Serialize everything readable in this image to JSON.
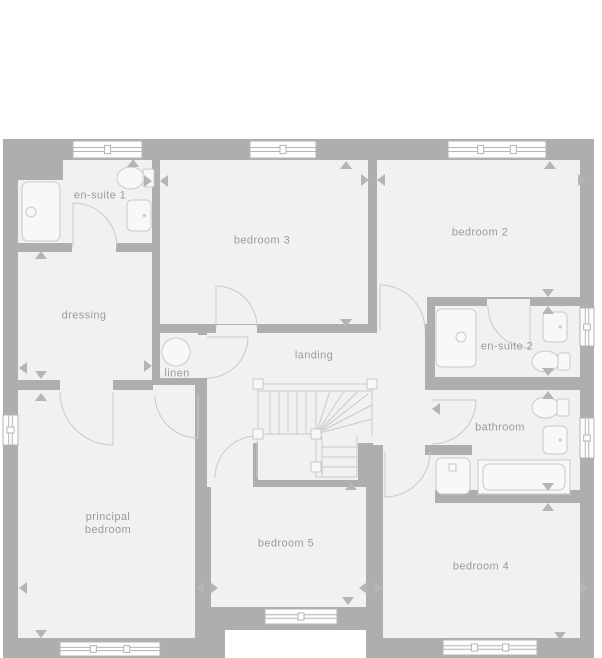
{
  "title": "first floor plan",
  "colors": {
    "wall": "#aeaeae",
    "floor": "#f1f1f1",
    "page": "#ffffff",
    "line": "#c9c9c9",
    "fixture_fill": "#f8f8f8",
    "window_fill": "#fdfdfd",
    "window_stroke": "#b5b5b5",
    "marker": "#b5b5b5",
    "label": "#9b9b9b"
  },
  "rooms": [
    {
      "id": "en-suite-1",
      "label": "en-suite 1",
      "x": 100,
      "y": 196
    },
    {
      "id": "bedroom-3",
      "label": "bedroom 3",
      "x": 262,
      "y": 241
    },
    {
      "id": "bedroom-2",
      "label": "bedroom 2",
      "x": 480,
      "y": 233
    },
    {
      "id": "dressing",
      "label": "dressing",
      "x": 84,
      "y": 316
    },
    {
      "id": "linen",
      "label": "linen",
      "x": 177,
      "y": 374
    },
    {
      "id": "landing",
      "label": "landing",
      "x": 314,
      "y": 356
    },
    {
      "id": "en-suite-2",
      "label": "en-suite 2",
      "x": 507,
      "y": 347
    },
    {
      "id": "bathroom",
      "label": "bathroom",
      "x": 500,
      "y": 428
    },
    {
      "id": "principal-bedroom",
      "label": "principal\nbedroom",
      "x": 108,
      "y": 524
    },
    {
      "id": "bedroom-5",
      "label": "bedroom 5",
      "x": 286,
      "y": 544
    },
    {
      "id": "bedroom-4",
      "label": "bedroom 4",
      "x": 481,
      "y": 567
    }
  ],
  "floorplan": {
    "footprint": [
      3,
      139,
      591,
      519
    ],
    "cutouts": [
      [
        225,
        630,
        141,
        28
      ]
    ],
    "floors": [
      [
        63,
        160,
        89,
        83
      ],
      [
        18,
        180,
        45,
        63
      ],
      [
        18,
        252,
        134,
        128
      ],
      [
        160,
        333,
        38,
        45
      ],
      [
        160,
        160,
        208,
        164
      ],
      [
        377,
        160,
        203,
        137
      ],
      [
        377,
        160,
        50,
        164
      ],
      [
        435,
        306,
        145,
        71
      ],
      [
        435,
        390,
        145,
        55
      ],
      [
        472,
        445,
        108,
        45
      ],
      [
        435,
        455,
        37,
        35
      ],
      [
        18,
        390,
        177,
        248
      ],
      [
        211,
        487,
        155,
        120
      ],
      [
        211,
        443,
        42,
        44
      ],
      [
        383,
        455,
        52,
        183
      ],
      [
        435,
        503,
        145,
        135
      ],
      [
        207,
        333,
        166,
        110
      ],
      [
        207,
        443,
        41,
        44
      ],
      [
        258,
        443,
        100,
        37
      ],
      [
        368,
        333,
        57,
        57
      ],
      [
        373,
        390,
        62,
        55
      ],
      [
        72,
        243,
        44,
        9
      ],
      [
        60,
        380,
        53,
        12
      ],
      [
        153,
        385,
        42,
        12
      ],
      [
        198,
        335,
        9,
        43
      ],
      [
        216,
        325,
        41,
        8
      ],
      [
        377,
        324,
        48,
        9
      ],
      [
        487,
        299,
        43,
        9
      ],
      [
        383,
        443,
        42,
        14
      ],
      [
        211,
        475,
        42,
        12
      ]
    ],
    "windows": [
      {
        "x": 73,
        "y": 141,
        "w": 69,
        "h": 17,
        "orient": "h",
        "mullions": 1
      },
      {
        "x": 250,
        "y": 141,
        "w": 66,
        "h": 17,
        "orient": "h",
        "mullions": 1
      },
      {
        "x": 448,
        "y": 141,
        "w": 98,
        "h": 17,
        "orient": "h",
        "mullions": 2
      },
      {
        "x": 3,
        "y": 415,
        "w": 15,
        "h": 30,
        "orient": "v",
        "mullions": 1
      },
      {
        "x": 580,
        "y": 308,
        "w": 14,
        "h": 38,
        "orient": "v",
        "mullions": 1
      },
      {
        "x": 580,
        "y": 418,
        "w": 14,
        "h": 40,
        "orient": "v",
        "mullions": 1
      },
      {
        "x": 60,
        "y": 642,
        "w": 100,
        "h": 14,
        "orient": "h",
        "mullions": 2
      },
      {
        "x": 265,
        "y": 609,
        "w": 72,
        "h": 15,
        "orient": "h",
        "mullions": 1
      },
      {
        "x": 443,
        "y": 640,
        "w": 94,
        "h": 15,
        "orient": "h",
        "mullions": 2
      }
    ],
    "doors": [
      {
        "r": 44,
        "start": [
          117,
          247
        ],
        "end": [
          73,
          203
        ],
        "sweep": 0,
        "leaf": [
          73,
          247,
          73,
          203
        ]
      },
      {
        "r": 53,
        "start": [
          60,
          392
        ],
        "end": [
          113,
          445
        ],
        "sweep": 0,
        "leaf": [
          113,
          392,
          113,
          445
        ]
      },
      {
        "r": 43,
        "start": [
          155,
          395
        ],
        "end": [
          198,
          438
        ],
        "sweep": 0,
        "leaf": [
          198,
          395,
          198,
          438
        ]
      },
      {
        "r": 41,
        "start": [
          248,
          337
        ],
        "end": [
          207,
          378
        ],
        "sweep": 1,
        "leaf": [
          207,
          337,
          248,
          337
        ]
      },
      {
        "r": 41,
        "start": [
          257,
          327
        ],
        "end": [
          216,
          286
        ],
        "sweep": 0,
        "leaf": [
          216,
          327,
          216,
          286
        ]
      },
      {
        "r": 45,
        "start": [
          425,
          330
        ],
        "end": [
          380,
          285
        ],
        "sweep": 0,
        "leaf": [
          380,
          330,
          380,
          285
        ]
      },
      {
        "r": 42,
        "start": [
          488,
          306
        ],
        "end": [
          530,
          348
        ],
        "sweep": 0,
        "leaf": [
          530,
          306,
          530,
          348
        ]
      },
      {
        "r": 44,
        "start": [
          432,
          444
        ],
        "end": [
          476,
          400
        ],
        "sweep": 0,
        "leaf": [
          432,
          400,
          476,
          400
        ]
      },
      {
        "r": 45,
        "start": [
          430,
          452
        ],
        "end": [
          385,
          497
        ],
        "sweep": 1,
        "leaf": [
          385,
          452,
          385,
          497
        ]
      },
      {
        "r": 42,
        "start": [
          215,
          478
        ],
        "end": [
          257,
          436
        ],
        "sweep": 1,
        "leaf": [
          257,
          478,
          257,
          436
        ]
      }
    ],
    "stairs": {
      "posts": [
        [
          253,
          379
        ],
        [
          367,
          379
        ],
        [
          253,
          429
        ],
        [
          311,
          429
        ],
        [
          311,
          462
        ]
      ],
      "lines": [
        [
          258,
          384,
          372,
          384
        ],
        [
          258,
          391,
          372,
          391
        ],
        [
          258,
          384,
          258,
          434
        ],
        [
          372,
          384,
          372,
          436
        ],
        [
          258,
          434,
          311,
          434
        ],
        [
          270,
          391,
          270,
          434
        ],
        [
          279,
          391,
          279,
          434
        ],
        [
          288,
          391,
          288,
          434
        ],
        [
          297,
          391,
          297,
          434
        ],
        [
          306,
          391,
          306,
          434
        ],
        [
          316,
          434,
          316,
          391
        ],
        [
          316,
          434,
          330,
          391
        ],
        [
          316,
          434,
          344,
          391
        ],
        [
          316,
          434,
          358,
          391
        ],
        [
          316,
          434,
          368,
          394
        ],
        [
          316,
          434,
          372,
          405
        ],
        [
          316,
          434,
          372,
          419
        ],
        [
          316,
          436,
          316,
          477
        ],
        [
          322,
          436,
          322,
          477
        ],
        [
          357,
          436,
          357,
          477
        ],
        [
          322,
          447,
          357,
          447
        ],
        [
          322,
          457,
          357,
          457
        ],
        [
          322,
          467,
          357,
          467
        ],
        [
          316,
          477,
          357,
          477
        ]
      ]
    },
    "fixtures": [
      {
        "type": "shower",
        "x": 22,
        "y": 182,
        "w": 38,
        "h": 59,
        "drain": [
          31,
          212,
          5
        ]
      },
      {
        "type": "toilet",
        "x": 117,
        "y": 167,
        "w": 27,
        "h": 22,
        "tank": [
          143,
          169,
          11,
          18
        ]
      },
      {
        "type": "sink",
        "x": 127,
        "y": 200,
        "w": 24,
        "h": 31
      },
      {
        "type": "tank-circle",
        "cx": 176,
        "cy": 352,
        "r": 14
      },
      {
        "type": "shower",
        "x": 436,
        "y": 309,
        "w": 40,
        "h": 58,
        "drain": [
          461,
          337,
          5
        ]
      },
      {
        "type": "sink",
        "x": 543,
        "y": 312,
        "w": 24,
        "h": 30
      },
      {
        "type": "toilet",
        "x": 532,
        "y": 351,
        "w": 27,
        "h": 21,
        "tank": [
          558,
          353,
          12,
          17
        ]
      },
      {
        "type": "toilet",
        "x": 532,
        "y": 397,
        "w": 27,
        "h": 21,
        "tank": [
          557,
          399,
          12,
          17
        ]
      },
      {
        "type": "sink",
        "x": 543,
        "y": 426,
        "w": 24,
        "h": 28
      },
      {
        "type": "shower",
        "x": 436,
        "y": 458,
        "w": 34,
        "h": 36,
        "drain_sq": [
          449,
          464,
          7,
          7
        ]
      },
      {
        "type": "bath",
        "x": 478,
        "y": 460,
        "w": 92,
        "h": 34
      }
    ],
    "markers": [
      [
        133,
        163,
        "up"
      ],
      [
        346,
        165,
        "up"
      ],
      [
        550,
        165,
        "up"
      ],
      [
        148,
        181,
        "right"
      ],
      [
        164,
        181,
        "left"
      ],
      [
        365,
        180,
        "right"
      ],
      [
        381,
        180,
        "left"
      ],
      [
        582,
        180,
        "right"
      ],
      [
        41,
        255,
        "up"
      ],
      [
        23,
        368,
        "left"
      ],
      [
        148,
        366,
        "right"
      ],
      [
        41,
        375,
        "down"
      ],
      [
        41,
        397,
        "up"
      ],
      [
        346,
        323,
        "down"
      ],
      [
        548,
        293,
        "down"
      ],
      [
        548,
        310,
        "up"
      ],
      [
        548,
        372,
        "down"
      ],
      [
        548,
        395,
        "up"
      ],
      [
        436,
        409,
        "left"
      ],
      [
        351,
        486,
        "up"
      ],
      [
        548,
        487,
        "down"
      ],
      [
        548,
        507,
        "up"
      ],
      [
        23,
        588,
        "left"
      ],
      [
        200,
        588,
        "left"
      ],
      [
        214,
        588,
        "right"
      ],
      [
        363,
        588,
        "left"
      ],
      [
        379,
        588,
        "right"
      ],
      [
        584,
        588,
        "right"
      ],
      [
        348,
        601,
        "down"
      ],
      [
        41,
        634,
        "down"
      ],
      [
        560,
        636,
        "down"
      ]
    ]
  }
}
